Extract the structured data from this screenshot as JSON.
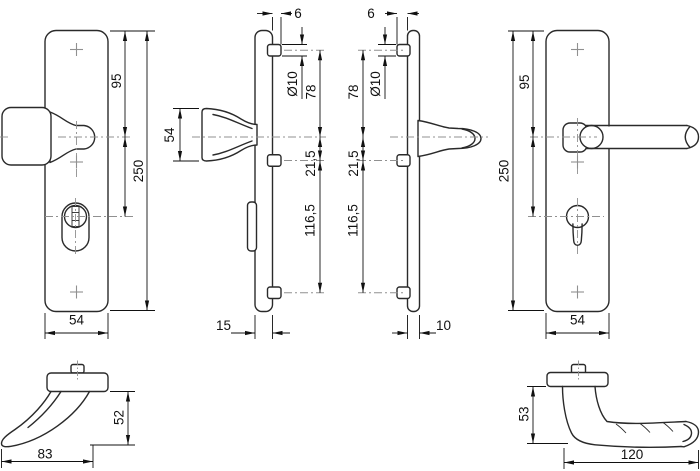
{
  "colors": {
    "background": "#ffffff",
    "outline": "#2a2a2a",
    "dimension": "#111111",
    "centerline": "#909090"
  },
  "views": {
    "knob_plate_front": {
      "top_to_handle": "95",
      "plate_height": "250",
      "plate_width": "54"
    },
    "knob_end": {
      "knob_height": "54"
    },
    "knob_plate_side": {
      "boss_protrusion": "6",
      "screw_hole_dia": "Ø10",
      "screw_to_handle": "78",
      "handle_to_screw": "21,5",
      "screw_to_screw": "116,5",
      "plate_thickness": "15"
    },
    "lever_plate_side": {
      "boss_protrusion": "6",
      "screw_to_handle": "78",
      "screw_hole_dia": "Ø10",
      "handle_to_screw": "21,5",
      "screw_to_screw": "116,5",
      "plate_thickness": "10"
    },
    "lever_plate_front": {
      "top_to_handle": "95",
      "plate_height": "250",
      "plate_width": "54"
    },
    "knob_profile": {
      "grip_height": "52",
      "grip_length": "83"
    },
    "lever_profile": {
      "grip_height": "53",
      "grip_length": "120"
    }
  }
}
